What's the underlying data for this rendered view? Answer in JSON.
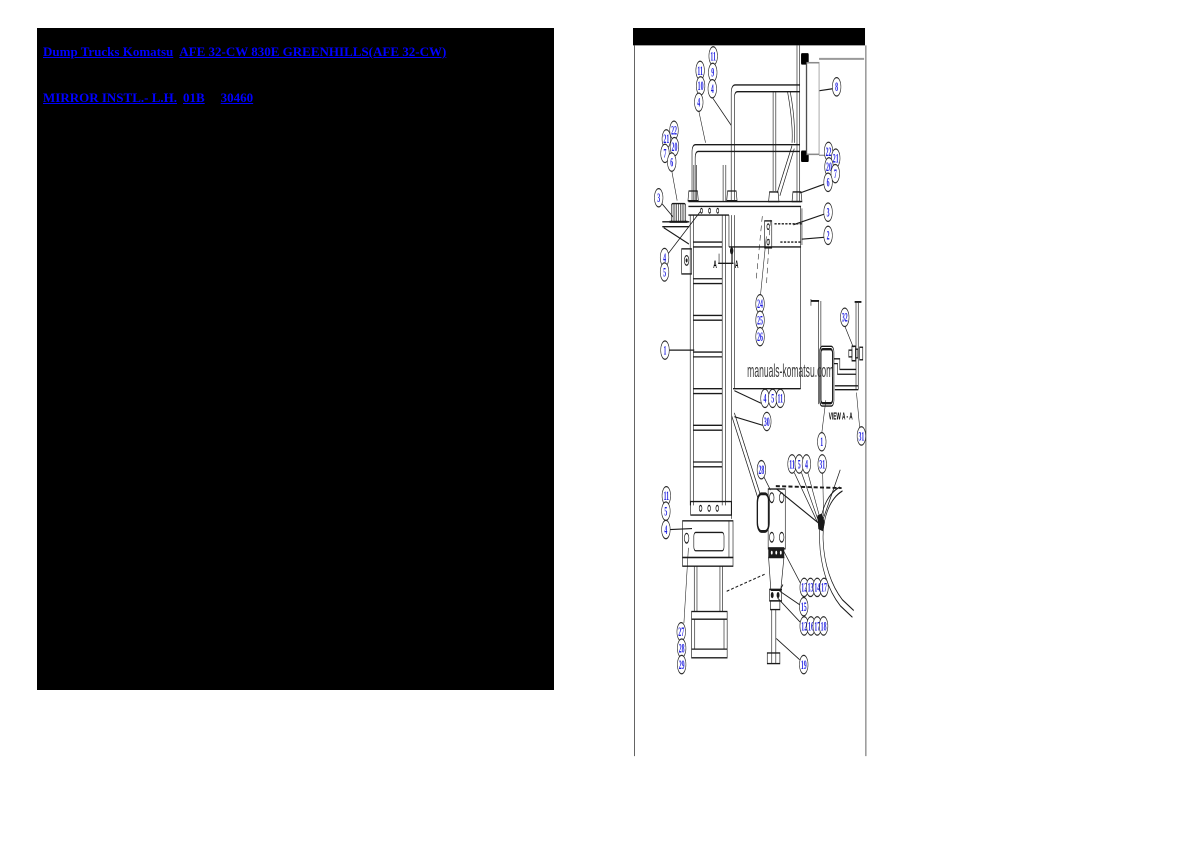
{
  "header": {
    "breadcrumb_link": "Dump Trucks Komatsu",
    "model_link": "AFE 32-CW 830E  GREENHILLS(AFE 32-CW)",
    "title_link": "MIRROR INSTL.- L.H.",
    "sheet_code": "01B",
    "part_number": "30460"
  },
  "diagram": {
    "watermark": "manuals-komatsu.com",
    "view_label": "VIEW A - A",
    "section_letter_left": "A",
    "section_letter_right": "A",
    "colors": {
      "link_blue": "#0101ff",
      "callout_blue": "#1d1de0",
      "line": "#1a1a1a",
      "watermark_gray": "#3b3b3b",
      "panel_black": "#000000"
    },
    "callouts": [
      {
        "label": "11",
        "x": 811,
        "y": 57
      },
      {
        "label": "9",
        "x": 810,
        "y": 74
      },
      {
        "label": "4",
        "x": 809,
        "y": 91
      },
      {
        "label": "11",
        "x": 782,
        "y": 72
      },
      {
        "label": "10",
        "x": 783,
        "y": 88
      },
      {
        "label": "4",
        "x": 779,
        "y": 105
      },
      {
        "label": "22",
        "x": 724,
        "y": 134
      },
      {
        "label": "21",
        "x": 707,
        "y": 143
      },
      {
        "label": "20",
        "x": 725,
        "y": 151
      },
      {
        "label": "7",
        "x": 704,
        "y": 158
      },
      {
        "label": "6",
        "x": 719,
        "y": 167
      },
      {
        "label": "3",
        "x": 690,
        "y": 204
      },
      {
        "label": "4",
        "x": 703,
        "y": 266
      },
      {
        "label": "5",
        "x": 703,
        "y": 281
      },
      {
        "label": "8",
        "x": 1085,
        "y": 89
      },
      {
        "label": "22",
        "x": 1067,
        "y": 156
      },
      {
        "label": "21",
        "x": 1083,
        "y": 163
      },
      {
        "label": "20",
        "x": 1068,
        "y": 172
      },
      {
        "label": "7",
        "x": 1082,
        "y": 179
      },
      {
        "label": "6",
        "x": 1066,
        "y": 188
      },
      {
        "label": "3",
        "x": 1066,
        "y": 219
      },
      {
        "label": "2",
        "x": 1066,
        "y": 243
      },
      {
        "label": "24",
        "x": 915,
        "y": 314
      },
      {
        "label": "25",
        "x": 915,
        "y": 331
      },
      {
        "label": "26",
        "x": 915,
        "y": 348
      },
      {
        "label": "1",
        "x": 704,
        "y": 362
      },
      {
        "label": "4",
        "x": 926,
        "y": 412
      },
      {
        "label": "5",
        "x": 943,
        "y": 412
      },
      {
        "label": "11",
        "x": 960,
        "y": 412
      },
      {
        "label": "30",
        "x": 930,
        "y": 436
      },
      {
        "label": "32",
        "x": 1103,
        "y": 328
      },
      {
        "label": "11",
        "x": 707,
        "y": 513
      },
      {
        "label": "5",
        "x": 706,
        "y": 529
      },
      {
        "label": "4",
        "x": 706,
        "y": 548
      },
      {
        "label": "1",
        "x": 1052,
        "y": 457
      },
      {
        "label": "31",
        "x": 1140,
        "y": 451
      },
      {
        "label": "28",
        "x": 918,
        "y": 486
      },
      {
        "label": "11",
        "x": 986,
        "y": 480
      },
      {
        "label": "5",
        "x": 1002,
        "y": 480
      },
      {
        "label": "4",
        "x": 1018,
        "y": 480
      },
      {
        "label": "31",
        "x": 1053,
        "y": 480
      },
      {
        "label": "12",
        "x": 1013,
        "y": 608
      },
      {
        "label": "13",
        "x": 1027,
        "y": 608
      },
      {
        "label": "14",
        "x": 1042,
        "y": 608
      },
      {
        "label": "17",
        "x": 1057,
        "y": 608
      },
      {
        "label": "15",
        "x": 1012,
        "y": 628
      },
      {
        "label": "12",
        "x": 1013,
        "y": 648
      },
      {
        "label": "16",
        "x": 1028,
        "y": 648
      },
      {
        "label": "17",
        "x": 1042,
        "y": 648
      },
      {
        "label": "18",
        "x": 1056,
        "y": 648
      },
      {
        "label": "19",
        "x": 1012,
        "y": 688
      },
      {
        "label": "27",
        "x": 740,
        "y": 654
      },
      {
        "label": "28",
        "x": 741,
        "y": 671
      },
      {
        "label": "29",
        "x": 741,
        "y": 688
      }
    ],
    "leaders": [
      {
        "x1": 809,
        "y1": 100,
        "x2": 851,
        "y2": 129,
        "dashed": false
      },
      {
        "x1": 779,
        "y1": 114,
        "x2": 794,
        "y2": 147,
        "dashed": false
      },
      {
        "x1": 719,
        "y1": 176,
        "x2": 731,
        "y2": 207,
        "dashed": false
      },
      {
        "x1": 697,
        "y1": 210,
        "x2": 722,
        "y2": 224,
        "dashed": false
      },
      {
        "x1": 711,
        "y1": 262,
        "x2": 783,
        "y2": 218,
        "dashed": false
      },
      {
        "x1": 1076,
        "y1": 91,
        "x2": 1047,
        "y2": 93,
        "dashed": false
      },
      {
        "x1": 1057,
        "y1": 190,
        "x2": 1004,
        "y2": 199,
        "dashed": false
      },
      {
        "x1": 1057,
        "y1": 221,
        "x2": 989,
        "y2": 232,
        "dashed": false
      },
      {
        "x1": 1057,
        "y1": 245,
        "x2": 1007,
        "y2": 247,
        "dashed": false
      },
      {
        "x1": 916,
        "y1": 305,
        "x2": 929,
        "y2": 244,
        "dashed": false
      },
      {
        "x1": 713,
        "y1": 362,
        "x2": 769,
        "y2": 362,
        "dashed": false
      },
      {
        "x1": 917,
        "y1": 417,
        "x2": 858,
        "y2": 404,
        "dashed": false
      },
      {
        "x1": 921,
        "y1": 440,
        "x2": 858,
        "y2": 431,
        "dashed": false
      },
      {
        "x1": 715,
        "y1": 548,
        "x2": 764,
        "y2": 547,
        "dashed": false
      },
      {
        "x1": 1103,
        "y1": 337,
        "x2": 1122,
        "y2": 359,
        "dashed": false
      },
      {
        "x1": 1052,
        "y1": 448,
        "x2": 1061,
        "y2": 414,
        "dashed": false
      },
      {
        "x1": 1136,
        "y1": 442,
        "x2": 1129,
        "y2": 406,
        "dashed": false
      },
      {
        "x1": 923,
        "y1": 493,
        "x2": 938,
        "y2": 507,
        "dashed": false
      },
      {
        "x1": 991,
        "y1": 489,
        "x2": 1042,
        "y2": 540,
        "dashed": false
      },
      {
        "x1": 1007,
        "y1": 489,
        "x2": 1046,
        "y2": 541,
        "dashed": false
      },
      {
        "x1": 1021,
        "y1": 489,
        "x2": 1049,
        "y2": 538,
        "dashed": false
      },
      {
        "x1": 1054,
        "y1": 489,
        "x2": 1056,
        "y2": 534,
        "dashed": false
      },
      {
        "x1": 1004,
        "y1": 603,
        "x2": 967,
        "y2": 570,
        "dashed": false
      },
      {
        "x1": 1003,
        "y1": 626,
        "x2": 959,
        "y2": 612,
        "dashed": false
      },
      {
        "x1": 1004,
        "y1": 644,
        "x2": 954,
        "y2": 619,
        "dashed": false
      },
      {
        "x1": 1003,
        "y1": 683,
        "x2": 951,
        "y2": 661,
        "dashed": false
      },
      {
        "x1": 746,
        "y1": 645,
        "x2": 756,
        "y2": 567,
        "dashed": false
      },
      {
        "x1": 841,
        "y1": 612,
        "x2": 927,
        "y2": 594,
        "dashed": true
      },
      {
        "x1": 920,
        "y1": 223,
        "x2": 906,
        "y2": 291,
        "dashed": true
      },
      {
        "x1": 938,
        "y1": 227,
        "x2": 929,
        "y2": 296,
        "dashed": true
      }
    ]
  }
}
